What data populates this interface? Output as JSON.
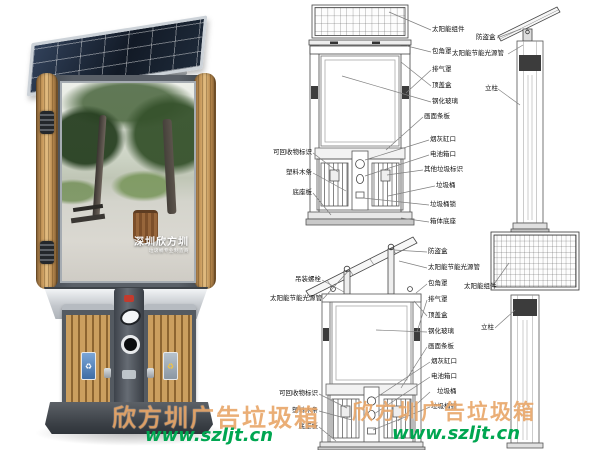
{
  "watermark": {
    "brand": "欣方圳广告垃圾箱",
    "url": "www.szljt.cn",
    "brand_color": "#de822d",
    "url_color": "#00a651"
  },
  "product_render": {
    "poster": {
      "title": "深圳欣方圳",
      "subtitle": "垃圾桶专业制造商"
    },
    "plaque_left_symbol": "♻",
    "plaque_right_symbol": "♻"
  },
  "diagrams": {
    "top_front": {
      "left_labels": [
        "可回收物标识",
        "塑料木条",
        "底座板"
      ],
      "right_labels_upper": [
        "太阳能组件",
        "包角罩",
        "排气罩",
        "顶盖盒",
        "钢化玻璃"
      ],
      "right_labels_lower": [
        "画面条板",
        "烟灰缸口",
        "电池箱口",
        "其他垃圾标识",
        "垃圾桶",
        "垃圾桶锁",
        "箱体底座"
      ]
    },
    "top_side": {
      "labels": [
        "防盗盒",
        "太阳能节能光源管",
        "立柱"
      ]
    },
    "bottom_front": {
      "left_labels_upper": [
        "吊装螺栓",
        "太阳能节能光源管"
      ],
      "left_labels_lower": [
        "可回收物标识",
        "塑料木条",
        "底座板"
      ],
      "right_labels_upper": [
        "防盗盒",
        "太阳能节能光源管",
        "包角罩",
        "排气罩",
        "顶盖盒",
        "钢化玻璃",
        "画面条板"
      ],
      "right_labels_lower": [
        "烟灰缸口",
        "电池箱口",
        "垃圾桶",
        "垃圾桶锁"
      ]
    },
    "bottom_side": {
      "labels": [
        "太阳能组件",
        "立柱"
      ]
    }
  }
}
